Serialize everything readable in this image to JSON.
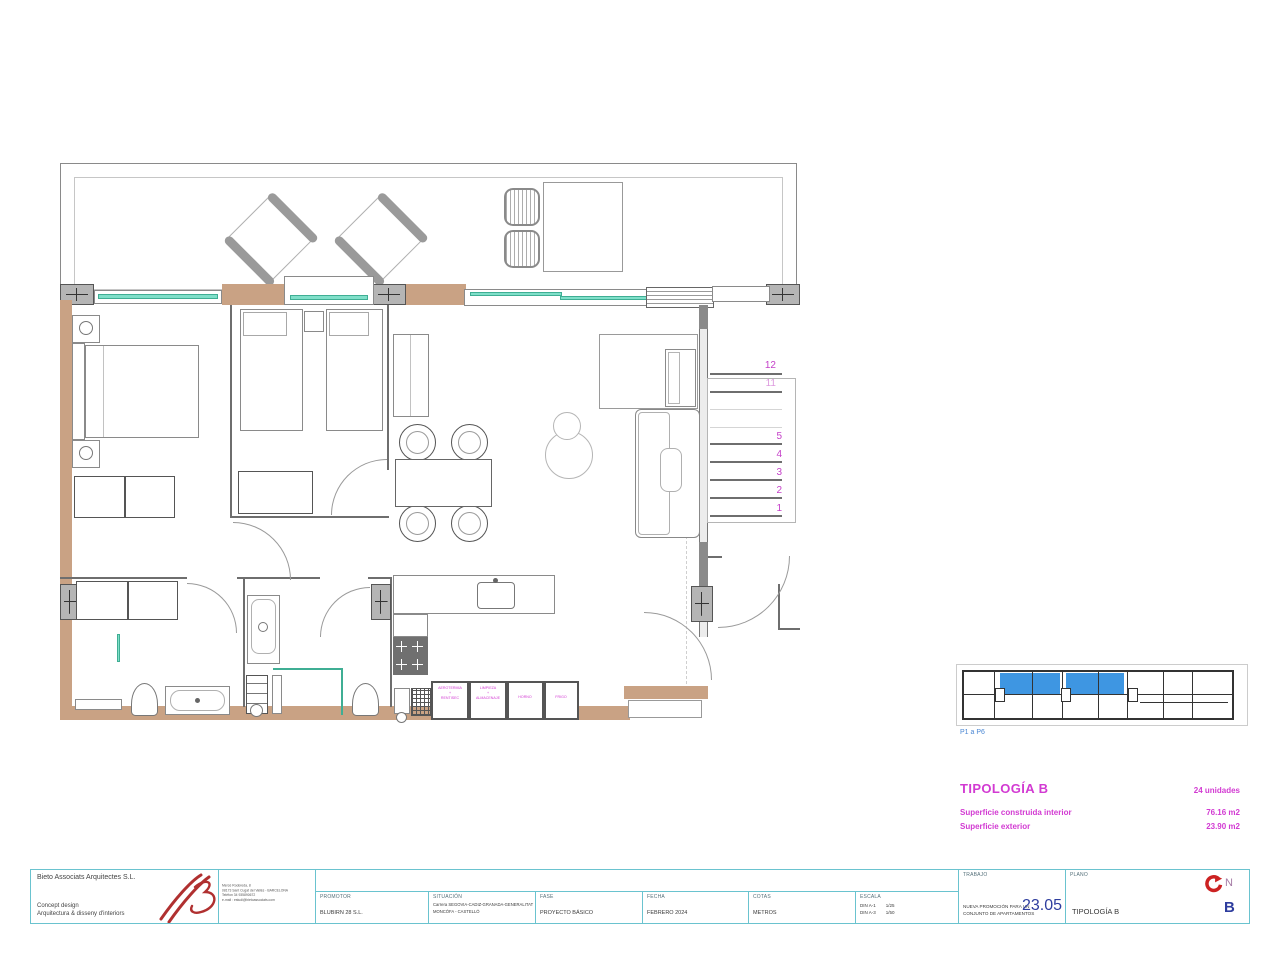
{
  "colors": {
    "magenta": "#d23ad2",
    "stair_magenta": "#c43fc8",
    "keyplan_blue_fill": "#3e96e2",
    "keyplan_caption_blue": "#4a87d4",
    "titleblock_teal": "#6ac3cf",
    "navy_numbers": "#2e3d9e",
    "glazing_teal": "#7fdfc9",
    "wall_tan": "#c9a284",
    "north_red": "#cc2222"
  },
  "plan": {
    "stairs": [
      "12",
      "11",
      "5",
      "4",
      "3",
      "2",
      "1"
    ],
    "appliances": [
      "AEROTERMIA\n+\nRENTISEC",
      "LIMPIEZA\n+\nALMACENAJE",
      "HORNO",
      "FRIGO"
    ]
  },
  "keyplan": {
    "caption": "P1 a P6"
  },
  "typology": {
    "title": "TIPOLOGÍA B",
    "units": "24 unidades",
    "rows": [
      {
        "label": "Superficie construida interior",
        "value": "76.16 m2"
      },
      {
        "label": "Superficie exterior",
        "value": "23.90 m2"
      }
    ]
  },
  "titleblock": {
    "company": "Bieto Associats Arquitectes S.L.",
    "tagline1": "Concept  design",
    "tagline2": "Arquitectura  &  disseny  d'interiors",
    "address": "Mercè Rodoreda, 8\n08173 Sant Cugat del Vallès  -  BARCELONA\nTelèfon  34  935890672\ne-mail : estudi@bietoassociats.com",
    "fields": [
      {
        "label": "PROMOTOR",
        "value": "BLUBIRN 28 S.L."
      },
      {
        "label": "SITUACIÓN",
        "value": "Carrera SEGOVIA-CADIZ-GRANADA-GENERALITAT\nMONCÓFA - CASTELLÓ"
      },
      {
        "label": "FASE",
        "value": "PROYECTO BÁSICO"
      },
      {
        "label": "FECHA",
        "value": "FEBRERO 2024"
      },
      {
        "label": "COTAS",
        "value": "METROS"
      },
      {
        "label": "ESCALA",
        "value": "DIN A-1        1/25\nDIN A-3        1/50"
      }
    ],
    "trabajo": {
      "label": "TRABAJO",
      "desc": "NUEVA PROMOCIÓN PARA UN\nCONJUNTO DE APARTAMENTOS",
      "number": "23.05"
    },
    "plano": {
      "label": "PLANO",
      "name": "TIPOLOGÍA B",
      "code": "B",
      "north": "N"
    }
  }
}
